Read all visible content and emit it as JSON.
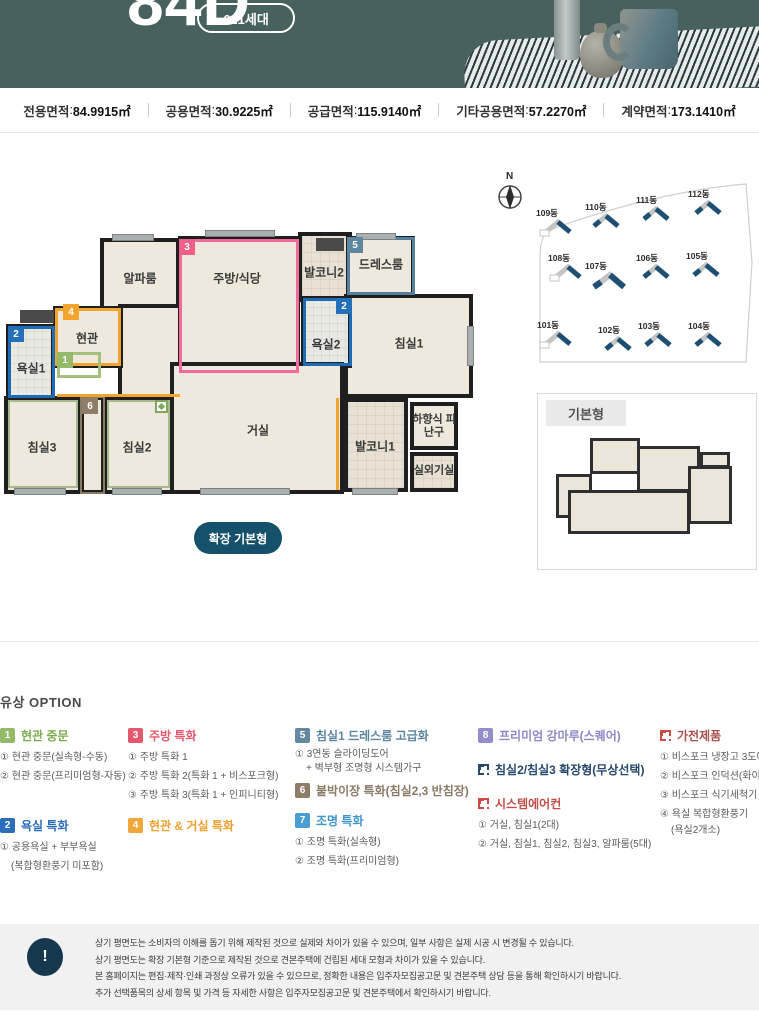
{
  "header": {
    "title": "84D",
    "badge": "621세대"
  },
  "area_bar": {
    "sep": " : ",
    "items": [
      {
        "label": "전용면적",
        "value": "84.9915㎡"
      },
      {
        "label": "공용면적",
        "value": "30.9225㎡"
      },
      {
        "label": "공급면적",
        "value": "115.9140㎡"
      },
      {
        "label": "기타공용면적",
        "value": "57.2270㎡"
      },
      {
        "label": "계약면적",
        "value": "173.1410㎡"
      }
    ]
  },
  "plan": {
    "rooms": [
      "알파룸",
      "주방/식당",
      "발코니2",
      "드레스룸",
      "침실1",
      "욕실2",
      "현관",
      "욕실1",
      "침실3",
      "침실2",
      "거실",
      "발코니1",
      "하향식 피난구",
      "실외기실"
    ],
    "badges": [
      "1",
      "2",
      "3",
      "4",
      "5",
      "6"
    ],
    "expand_button": "확장 기본형"
  },
  "site_map": {
    "compass": "N",
    "buildings": [
      "109동",
      "110동",
      "111동",
      "112동",
      "108동",
      "107동",
      "106동",
      "105동",
      "101동",
      "102동",
      "103동",
      "104동"
    ]
  },
  "base_plan": {
    "label": "기본형"
  },
  "options": {
    "title": "유상 OPTION",
    "groups": [
      {
        "badge": "1",
        "title": "현관 중문",
        "items": [
          "① 현관 중문(실속형-수동)",
          "② 현관 중문(프리미엄형-자동)"
        ]
      },
      {
        "badge": "2",
        "title": "욕실 특화",
        "items": [
          "① 공용욕실 + 부부욕실",
          "(복합형환풍기 미포함)"
        ]
      },
      {
        "badge": "3",
        "title": "주방 특화",
        "items": [
          "① 주방 특화 1",
          "② 주방 특화 2(특화 1 + 비스포크형)",
          "③ 주방 특화 3(특화 1 + 인피니티형)"
        ]
      },
      {
        "badge": "4",
        "title": "현관 & 거실 특화",
        "items": []
      },
      {
        "badge": "5",
        "title": "침실1 드레스룸 고급화",
        "items": [
          "① 3연동 슬라이딩도어",
          "+ 벽부형 조명형 시스템가구"
        ]
      },
      {
        "badge": "6",
        "title": "붙박이장 특화(침실2,3 반침장)",
        "items": []
      },
      {
        "badge": "7",
        "title": "조명 특화",
        "items": [
          "① 조명 특화(실속형)",
          "② 조명 특화(프리미엄형)"
        ]
      },
      {
        "badge": "8",
        "title": "프리미엄 강마루(스퀘어)",
        "items": []
      },
      {
        "badge": "",
        "title": "침실2/침실3 확장형(무상선택)",
        "items": []
      },
      {
        "badge": "",
        "title": "시스템에어컨",
        "items": [
          "① 거실, 침실1(2대)",
          "② 거실, 침실1, 침실2, 침실3, 알파룸(5대)"
        ]
      },
      {
        "badge": "",
        "title": "가전제품",
        "items": [
          "① 비스포크 냉장고 3도어",
          "② 비스포크 인덕션(화이트)",
          "③ 비스포크 식기세척기",
          "④ 욕실 복합형환풍기",
          "(욕실2개소)"
        ]
      }
    ]
  },
  "notice": {
    "mark": "!",
    "lines": [
      "상기 평면도는 소비자의 이해를 돕기 위해 제작된 것으로 실제와 차이가 있을 수 있으며, 일부 사항은 실제 시공 시 변경될 수 있습니다.",
      "상기 평면도는 확장 기본형 기준으로 제작된 것으로 견본주택에 건립된 세대 모형과 차이가 있을 수 있습니다.",
      "본 홈페이지는 편집·제작·인쇄 과정상 오류가 있을 수 있으므로, 정확한 내용은 입주자모집공고문 및 견본주택 상담 등을 통해 확인하시기 바랍니다.",
      "추가 선택품목의 상세 항목 및 가격 등 자세한 사항은 입주자모집공고문 및 견본주택에서 확인하시기 바랍니다."
    ]
  },
  "colors": {
    "header_teal": "#47615f",
    "button_navy": "#15516b",
    "notice_navy": "#16384f",
    "badge_green": "#95ba67",
    "badge_blue": "#2a6db8",
    "badge_pink": "#e4586e",
    "badge_orange": "#f0a63a",
    "badge_slate": "#64889f",
    "badge_brown": "#8d7d69",
    "badge_sky": "#4a9cd2",
    "badge_purple": "#938ec9",
    "icon_navy": "#27486b",
    "icon_red": "#cb4a42",
    "site_building_navy": "#1d4f74"
  }
}
